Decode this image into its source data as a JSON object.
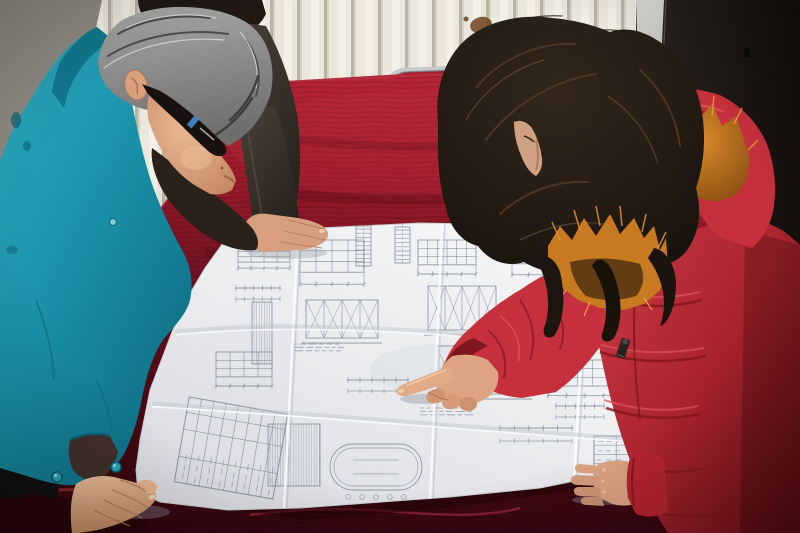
{
  "scene": {
    "description": "Two workers review a large folded engineering blueprint spread on a table covered with dark red velvet. A gray-haired man in a teal work jacket and dark glasses leans over the sheet on the left with one hand on its corner; a woman in a red winter coat with an orange fur-trimmed hood points at a detail with her index finger while her other hand rests on the sheet; a third person's dark-sleeved arm rests on the top edge. Behind them are a cream wall radiator with vertical fins, a gray wall corner, a chrome-framed chair with a red seat, and a dark door with a pale frame strip.",
    "people": [
      {
        "id": "man-left",
        "hair": "gray",
        "clothing": "teal work jacket over dark shirt",
        "accessory": "dark rectangular glasses",
        "pose": "leaning over table, left hand holding blueprint corner"
      },
      {
        "id": "bystander-behind",
        "hair": "black",
        "clothing": "dark gray jacket",
        "pose": "hand resting on top edge of blueprint"
      },
      {
        "id": "woman-right",
        "hair": "long dark brown, wavy",
        "clothing": "red puffer coat with orange fur hood trim",
        "pose": "pointing at blueprint with right index finger, left hand resting on sheet"
      }
    ],
    "objects": [
      {
        "id": "blueprint",
        "kind": "large folded engineering drawing sheet with fine line drawings, dimension chains and title block"
      },
      {
        "id": "table",
        "kind": "table draped with dark red velvet cloth"
      },
      {
        "id": "chair",
        "kind": "chrome tube chair with red seat behind table"
      },
      {
        "id": "radiator",
        "kind": "cream wall radiator with vertical fins"
      },
      {
        "id": "door",
        "kind": "dark door with pale frame strip on right"
      },
      {
        "id": "wall-stain",
        "kind": "brown smudge on radiator wall"
      }
    ],
    "palette": {
      "wall_gray": "#8e8c83",
      "radiator_cream": "#eae7dd",
      "radiator_shadow": "#b9b3a4",
      "door_dark": "#1b1713",
      "door_frame_light": "#d6d5cf",
      "velvet_bright": "#a81e2f",
      "velvet_dark": "#3f070f",
      "chair_chrome": "#c6cacd",
      "chair_seat": "#9c1f2a",
      "paper": "#edeff1",
      "drawing_ink": "#7d8498",
      "teal_jacket": "#1f9ab1",
      "teal_shadow": "#11788e",
      "dark_jacket": "#3e362f",
      "gray_hair": "#8f8f8d",
      "dark_hair": "#1e1712",
      "skin": "#dcA482",
      "skin_shadow": "#b17a56",
      "coat_red": "#c5303c",
      "coat_fold": "#8a1a24",
      "fur_orange": "#c87a20",
      "fur_tip": "#ecaa45",
      "undershirt": "#2a211a",
      "stain_brown": "#6f431f"
    },
    "blueprint": {
      "clusters": [
        {
          "x": 238,
          "y": 246,
          "w": 52,
          "h": 26,
          "kind": "elev"
        },
        {
          "x": 236,
          "y": 288,
          "w": 44,
          "h": 22,
          "kind": "dims"
        },
        {
          "x": 252,
          "y": 302,
          "w": 20,
          "h": 62,
          "kind": "hatch"
        },
        {
          "x": 300,
          "y": 240,
          "w": 64,
          "h": 52,
          "kind": "elev"
        },
        {
          "x": 306,
          "y": 300,
          "w": 72,
          "h": 38,
          "kind": "truss"
        },
        {
          "x": 294,
          "y": 344,
          "w": 50,
          "h": 10,
          "kind": "text"
        },
        {
          "x": 356,
          "y": 226,
          "w": 15,
          "h": 40,
          "kind": "col"
        },
        {
          "x": 395,
          "y": 227,
          "w": 15,
          "h": 36,
          "kind": "col"
        },
        {
          "x": 418,
          "y": 240,
          "w": 58,
          "h": 40,
          "kind": "elev"
        },
        {
          "x": 428,
          "y": 286,
          "w": 68,
          "h": 44,
          "kind": "truss"
        },
        {
          "x": 512,
          "y": 234,
          "w": 66,
          "h": 48,
          "kind": "elev"
        },
        {
          "x": 536,
          "y": 292,
          "w": 66,
          "h": 42,
          "kind": "elev"
        },
        {
          "x": 600,
          "y": 244,
          "w": 56,
          "h": 36,
          "kind": "elev"
        },
        {
          "x": 608,
          "y": 296,
          "w": 64,
          "h": 48,
          "kind": "truss"
        },
        {
          "x": 556,
          "y": 338,
          "w": 46,
          "h": 9,
          "kind": "text"
        },
        {
          "x": 436,
          "y": 346,
          "w": 92,
          "h": 48,
          "kind": "truss"
        },
        {
          "x": 548,
          "y": 360,
          "w": 74,
          "h": 42,
          "kind": "elev"
        },
        {
          "x": 594,
          "y": 436,
          "w": 74,
          "h": 46,
          "kind": "table"
        },
        {
          "x": 500,
          "y": 428,
          "w": 72,
          "h": 26,
          "kind": "dims"
        },
        {
          "x": 556,
          "y": 406,
          "w": 48,
          "h": 22,
          "kind": "dims"
        },
        {
          "x": 420,
          "y": 408,
          "w": 54,
          "h": 10,
          "kind": "text"
        },
        {
          "x": 188,
          "y": 398,
          "w": 86,
          "h": 100,
          "kind": "titleblock",
          "rot": -80
        },
        {
          "x": 268,
          "y": 424,
          "w": 52,
          "h": 62,
          "kind": "hatch"
        },
        {
          "x": 330,
          "y": 444,
          "w": 92,
          "h": 46,
          "kind": "oval"
        },
        {
          "x": 216,
          "y": 352,
          "w": 56,
          "h": 40,
          "kind": "elev"
        },
        {
          "x": 348,
          "y": 380,
          "w": 60,
          "h": 22,
          "kind": "dims"
        },
        {
          "x": 238,
          "y": 226,
          "w": 40,
          "h": 9,
          "kind": "text"
        },
        {
          "x": 476,
          "y": 228,
          "w": 34,
          "h": 8,
          "kind": "text"
        }
      ],
      "folds": {
        "vertical": [
          [
            298,
            230,
            284,
            508
          ],
          [
            442,
            224,
            430,
            500
          ],
          [
            588,
            230,
            574,
            478
          ]
        ],
        "horizontal": [
          "M176,332 C300,320 480,330 640,354",
          "M152,404 C320,414 520,432 700,444"
        ]
      }
    }
  }
}
